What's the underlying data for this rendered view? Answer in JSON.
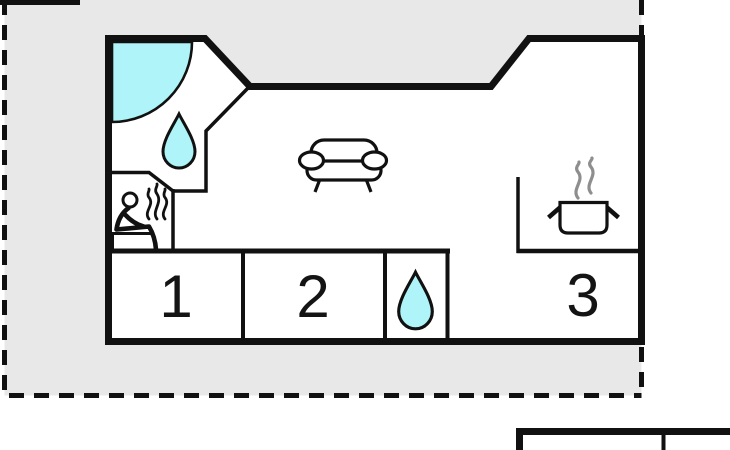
{
  "plan": {
    "rooms": [
      {
        "label": "1"
      },
      {
        "label": "2"
      },
      {
        "label": "3"
      }
    ],
    "features": {
      "shower_icon": "corner-shower-arc",
      "bathroom_icon": "water-drop",
      "sauna_icon": "person-on-bench-with-steam",
      "living_room_icon": "sofa",
      "kitchen_icon": "cooking-pot-with-steam",
      "small_room_icon": "water-drop"
    }
  },
  "colors": {
    "plot_fill": "#e8e8e8",
    "floor": "#ffffff",
    "wall": "#111111",
    "water_fill": "#aef4f8",
    "steam": "#8e8e8e",
    "room_number": "#141414"
  }
}
